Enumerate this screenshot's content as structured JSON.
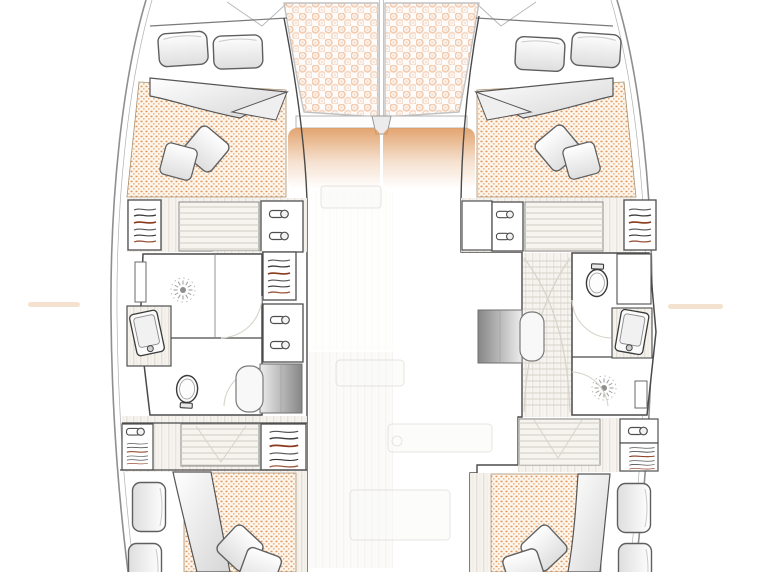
{
  "document": {
    "type": "yacht floor plan",
    "subject": "catamaran lower-deck accommodation layout",
    "orientation": "bow at top, stern at bottom",
    "visible_text": "none"
  },
  "colors": {
    "hull": "#8f8f8f",
    "wall": "#4a4a4a",
    "wood": "#f6f3ee",
    "wood_line": "#ddd8cf",
    "tread": "#cfccc3",
    "mattress_bg": "#fdf6ec",
    "mattress_dot": "#dd8440",
    "tramp_bg": "#fdfcfb",
    "tramp_dot": "#f1c3a4",
    "window": "#df9a60",
    "arc": "#d8d3ca",
    "accent": "#8a3a1c"
  },
  "bridgedeck": {
    "foredeck": {
      "trampoline_nets": [
        "port trampoline",
        "starboard trampoline"
      ],
      "mast_seam": "center line between nets",
      "forward_crossbeam": "white beam under trampolines",
      "tinted_windows": [
        "port coachroof window",
        "starboard coachroof window"
      ]
    },
    "saloon": "only faint ghosted outlines of floorboards and furniture in center"
  },
  "port_hull": {
    "side": "left",
    "sections_bow_to_stern": [
      {
        "name": "bow locker",
        "items": [
          "deck seam lines"
        ]
      },
      {
        "name": "forward cabin",
        "items": [
          "double berth platform",
          "2 pillows",
          "folded white duvet",
          "orange quilted mattress",
          "2 scatter cushions"
        ]
      },
      {
        "name": "forward landing",
        "items": [
          "hanging wardrobe (outboard)",
          "staircase",
          "cupboard with 2 drawer pulls (inboard)"
        ]
      },
      {
        "name": "bathroom",
        "items": [
          "shower with radial drain (forward)",
          "shower shelf",
          "angled washbasin (outboard)",
          "toilet (aft)",
          "door swing arcs"
        ]
      },
      {
        "name": "inboard storage",
        "items": [
          "hanging wardrobe",
          "cupboard with 2 drawer pulls",
          "companionway desk (gray) with rounded stool"
        ]
      },
      {
        "name": "aft landing",
        "items": [
          "cabinet with drawer pull and hanging rail (outboard)",
          "staircase",
          "hanging wardrobe (inboard)"
        ]
      },
      {
        "name": "aft cabin",
        "items": [
          "2 pillows (outboard)",
          "folded duvet wedge",
          "orange quilted mattress (inboard)",
          "2 scatter cushions",
          "wood trim strip"
        ]
      }
    ]
  },
  "starboard_hull": {
    "side": "right",
    "sections_bow_to_stern": [
      {
        "name": "bow locker",
        "items": [
          "deck seam lines"
        ]
      },
      {
        "name": "forward cabin",
        "items": [
          "double berth platform",
          "2 pillows",
          "folded white duvet",
          "orange quilted mattress",
          "2 scatter cushions"
        ]
      },
      {
        "name": "forward landing",
        "items": [
          "blank cabinet (inboard)",
          "cupboard with 2 drawer pulls",
          "staircase",
          "hanging wardrobe (outboard)"
        ]
      },
      {
        "name": "bathroom",
        "items": [
          "toilet (forward)",
          "white cabinet",
          "angled washbasin (outboard)",
          "shower with radial drain (aft)",
          "shower shelf",
          "door swing arcs"
        ]
      },
      {
        "name": "saloon-side desk",
        "items": [
          "companionway desk (gray) with rounded stool"
        ]
      },
      {
        "name": "aft landing",
        "items": [
          "staircase",
          "cabinet with drawer pull",
          "hanging rail cabinet (outboard)",
          "entry step"
        ]
      },
      {
        "name": "aft cabin",
        "items": [
          "orange quilted mattress (inboard)",
          "folded duvet wedge",
          "2 pillows (outboard)",
          "2 scatter cushions",
          "wood trim strip"
        ]
      }
    ]
  },
  "icons": {
    "hanger_rail": "rows of wavy lines (clothes on rail, one accent-colored)",
    "drawer_pull": "pill handle with round knob",
    "shower_drain": "radial sun-burst with center dot",
    "toilet": "oval bowl with cistern",
    "washbasin": "rounded rectangle with tap circle",
    "staircase": "horizontal tread lines",
    "trampoline": "polka-dot netting"
  }
}
